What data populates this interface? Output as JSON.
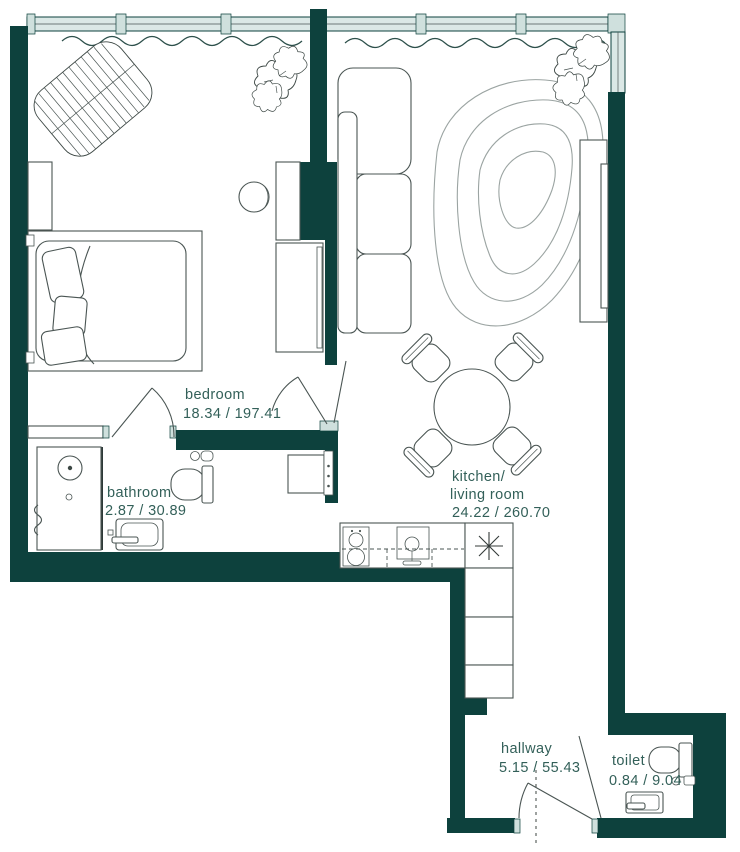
{
  "plan": {
    "rooms": {
      "bedroom": {
        "name": "bedroom",
        "area": "18.34 / 197.41"
      },
      "bathroom": {
        "name": "bathroom",
        "area": "2.87 / 30.89"
      },
      "kitchen_living": {
        "name_line1": "kitchen/",
        "name_line2": "living room",
        "area": "24.22 / 260.70"
      },
      "hallway": {
        "name": "hallway",
        "area": "5.15 / 55.43"
      },
      "toilet": {
        "name": "toilet",
        "area": "0.84 / 9.04"
      }
    },
    "symbols": {
      "kitchen_corner_star": "✳"
    },
    "colors": {
      "wall": "#0d413d",
      "glass": "#dbe8e6",
      "jamb": "#cfe0dd",
      "text": "#336059",
      "line": "#4a5553"
    }
  }
}
